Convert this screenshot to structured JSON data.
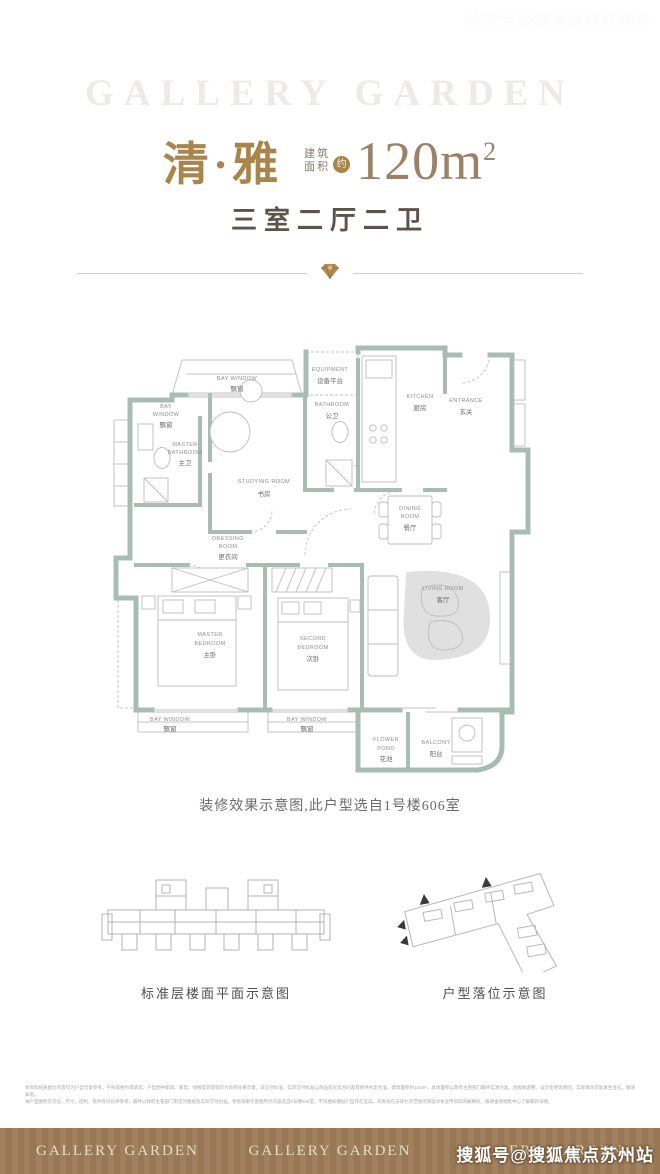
{
  "watermark": {
    "text": "搜狐号@搜狐焦点苏州站"
  },
  "header": {
    "brand_watermark": "GALLERY GARDEN",
    "unit_name": "清·雅",
    "area_prefix_line1": "建筑",
    "area_prefix_line2": "面积",
    "area_approx": "约",
    "area_value": "120m",
    "area_sup": "2",
    "layout_summary": "三室二厅二卫"
  },
  "floor_plan": {
    "rooms": {
      "bay_window_top": {
        "lines": [
          "BAY WINDOW",
          "飘窗"
        ]
      },
      "equipment": {
        "lines": [
          "EQUIPMENT",
          "设备平台"
        ]
      },
      "bathroom": {
        "lines": [
          "BATHROOM",
          "公卫"
        ]
      },
      "kitchen": {
        "lines": [
          "KITCHEN",
          "厨房"
        ]
      },
      "entrance": {
        "lines": [
          "ENTRANCE",
          "玄关"
        ]
      },
      "bay_window_left": {
        "lines": [
          "BAY",
          "WINDOW",
          "飘窗"
        ]
      },
      "master_bathroom": {
        "lines": [
          "MASTER",
          "BATHROOM",
          "主卫"
        ]
      },
      "studying_room": {
        "lines": [
          "STUDYING ROOM",
          "书房"
        ]
      },
      "dining_room": {
        "lines": [
          "DINING",
          "ROOM",
          "餐厅"
        ]
      },
      "dressing_room": {
        "lines": [
          "DRESSING",
          "ROOM",
          "更衣间"
        ]
      },
      "master_bedroom": {
        "lines": [
          "MASTER",
          "BEDROOM",
          "主卧"
        ]
      },
      "second_bedroom": {
        "lines": [
          "SECOND",
          "BEDROOM",
          "次卧"
        ]
      },
      "living_room": {
        "lines": [
          "LIVING ROOM",
          "客厅"
        ]
      },
      "bay_window_bottom_left": {
        "lines": [
          "BAY WINDOW",
          "飘窗"
        ]
      },
      "bay_window_bottom_mid": {
        "lines": [
          "BAY WINDOW",
          "飘窗"
        ]
      },
      "flower_pond": {
        "lines": [
          "FLOWER",
          "POND",
          "花池"
        ]
      },
      "balcony": {
        "lines": [
          "BALCONY",
          "阳台"
        ]
      }
    },
    "caption": "装修效果示意图,此户型选自1号楼606室"
  },
  "diagrams": {
    "floor_layout_caption": "标准层楼面平面示意图",
    "unit_position_caption": "户型落位示意图"
  },
  "disclaimer": {
    "line1": "本资料相关图文内容仅为户型示意参考，不构成要约或承诺。户型图中家具、家电、绿植及装饰等仅为装修效果示意，非交付标准，实际交付标准以商品房买卖合同及其附件约定为准。建筑面积约120m²，具体面积以政府主管部门最终实测为准。因规划调整、设计变更等原因，实际情况可能发生变化，敬请知悉。",
    "line2": "本户型图所示方位、尺寸、结构、管井等均仅供参考，最终以政府主管部门审定的图纸及实际交付为准。装修效果示意图所示内容选自1号楼606室，不同楼栋楼层户型存在差异。开发商在法律允许范围内保留对本宣传资料的解释权，敬请垂询销售中心了解最新详情。"
  },
  "footer": {
    "logos": [
      "GALLERY GARDEN",
      "GALLERY GARDEN",
      "GALLERY GARDEN"
    ]
  },
  "colors": {
    "gold": "#a8854a",
    "area_text": "#9b8166",
    "wall": "#a9bcb4",
    "footer_bg": "#9c7b57"
  }
}
